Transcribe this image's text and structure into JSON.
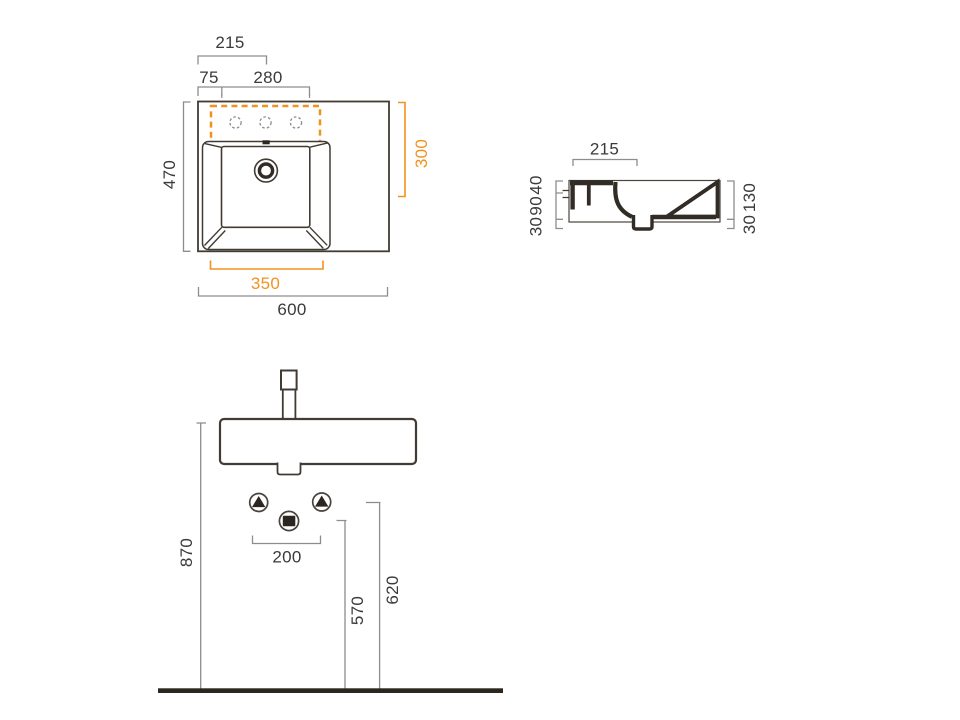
{
  "drawing_title": "Washbasin technical drawing",
  "colors": {
    "accent": "#f2921e",
    "line": "#413b34",
    "dim": "#8d8d8d",
    "text": "#3a3a3a"
  },
  "plan": {
    "drain_center_from_left": "215",
    "tap_hole_offset": "75",
    "tap_hole_span": "280",
    "total_depth": "470",
    "tap_area_depth": "300",
    "basin_width": "350",
    "total_width": "600"
  },
  "section": {
    "rim_depth": "215",
    "rim_thickness": "40",
    "bowl_depth": "90",
    "outlet_depth": "30",
    "front_height": "130",
    "outlet_clearance": "30"
  },
  "front": {
    "rim_height": "870",
    "supply_spacing": "200",
    "drain_outlet_height": "570",
    "supply_height": "620"
  }
}
